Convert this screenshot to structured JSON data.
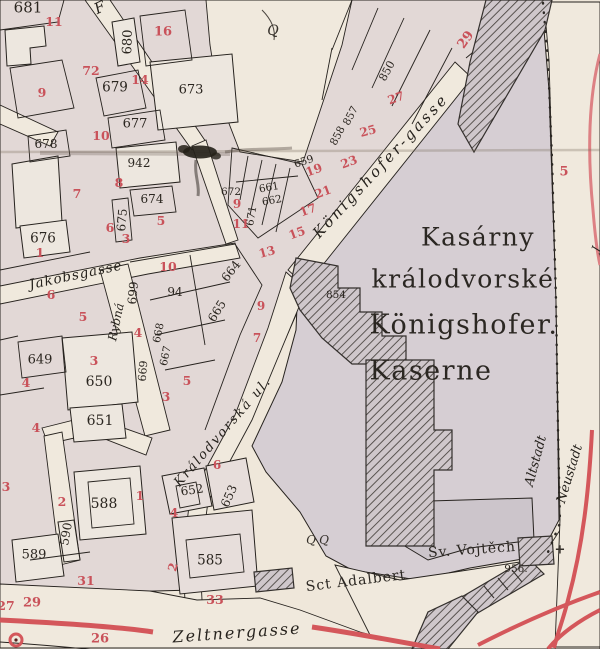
{
  "map_title": "Kasárny králodvorské / Königshofer Kaserne (historic city map detail)",
  "colors": {
    "paper": "#efe7da",
    "block": "#e2d8d6",
    "kaserne_block": "#d6ced3",
    "parcel_white": "#ede7df",
    "hatch_line": "#45403c",
    "outline": "#26221e",
    "house_number_red": "#c9525a",
    "road_red": "#d4575b",
    "boundary_dotted": "#2c2824"
  },
  "labels": {
    "streets": [
      {
        "text": "F",
        "x": 100,
        "y": 8,
        "r": -25,
        "s": 15
      },
      {
        "text": "Jakobsgasse",
        "x": 76,
        "y": 276,
        "r": -12,
        "s": 13.5,
        "ls": 1
      },
      {
        "text": "Rybná",
        "x": 116,
        "y": 322,
        "r": -78,
        "s": 12
      },
      {
        "text": "Königshofer-gasse",
        "x": 381,
        "y": 166,
        "r": -47,
        "s": 15,
        "ls": 3
      },
      {
        "text": "Králodvorská ul.",
        "x": 223,
        "y": 432,
        "r": -49,
        "s": 13,
        "ls": 2
      },
      {
        "text": "Zeltnergasse",
        "x": 237,
        "y": 633,
        "r": -4,
        "s": 16,
        "ls": 2
      },
      {
        "text": "Altstadt",
        "x": 536,
        "y": 461,
        "r": -75,
        "s": 13
      },
      {
        "text": "Neustadt",
        "x": 570,
        "y": 474,
        "r": -73,
        "s": 13
      },
      {
        "text": "J",
        "x": 596,
        "y": 249,
        "r": -70,
        "s": 11
      }
    ],
    "places": [
      {
        "text": "Kasárny",
        "x": 478,
        "y": 237,
        "r": 0,
        "s": 25
      },
      {
        "text": "králodvorské",
        "x": 463,
        "y": 279,
        "r": 0,
        "s": 25
      },
      {
        "text": "Königshofer.",
        "x": 464,
        "y": 325,
        "r": 0,
        "s": 27
      },
      {
        "text": "Kaserne",
        "x": 431,
        "y": 371,
        "r": 0,
        "s": 27
      },
      {
        "text": "Sct Adalbert",
        "x": 356,
        "y": 581,
        "r": -7,
        "s": 14,
        "ls": 1
      },
      {
        "text": "Sv. Vojtěch",
        "x": 472,
        "y": 550,
        "r": -4,
        "s": 14,
        "ls": 1
      }
    ],
    "parcel_numbers": [
      {
        "text": "681",
        "x": 28,
        "y": 8,
        "r": 0,
        "s": 15
      },
      {
        "text": "680",
        "x": 128,
        "y": 42,
        "r": -88,
        "s": 13
      },
      {
        "text": "679",
        "x": 115,
        "y": 88,
        "r": 0,
        "s": 13.5
      },
      {
        "text": "678",
        "x": 46,
        "y": 144,
        "r": 0,
        "s": 12
      },
      {
        "text": "677",
        "x": 135,
        "y": 124,
        "r": 0,
        "s": 13
      },
      {
        "text": "673",
        "x": 191,
        "y": 90,
        "r": 0,
        "s": 13
      },
      {
        "text": "942",
        "x": 139,
        "y": 163,
        "r": 0,
        "s": 12
      },
      {
        "text": "674",
        "x": 152,
        "y": 199,
        "r": 0,
        "s": 12
      },
      {
        "text": "675",
        "x": 122,
        "y": 220,
        "r": -85,
        "s": 12
      },
      {
        "text": "676",
        "x": 43,
        "y": 239,
        "r": 0,
        "s": 13.5
      },
      {
        "text": "672",
        "x": 231,
        "y": 192,
        "r": 0,
        "s": 10.5
      },
      {
        "text": "661",
        "x": 269,
        "y": 188,
        "r": -10,
        "s": 10.5
      },
      {
        "text": "662",
        "x": 272,
        "y": 201,
        "r": -10,
        "s": 10.5
      },
      {
        "text": "671",
        "x": 252,
        "y": 216,
        "r": -80,
        "s": 10.5
      },
      {
        "text": "659",
        "x": 304,
        "y": 162,
        "r": -18,
        "s": 10.5
      },
      {
        "text": "664",
        "x": 231,
        "y": 271,
        "r": -52,
        "s": 12
      },
      {
        "text": "665",
        "x": 217,
        "y": 311,
        "r": -58,
        "s": 12
      },
      {
        "text": "94",
        "x": 175,
        "y": 292,
        "r": 0,
        "s": 12
      },
      {
        "text": "699",
        "x": 133,
        "y": 293,
        "r": -85,
        "s": 12
      },
      {
        "text": "668",
        "x": 159,
        "y": 333,
        "r": -78,
        "s": 10.5
      },
      {
        "text": "667",
        "x": 166,
        "y": 356,
        "r": -78,
        "s": 10.5
      },
      {
        "text": "669",
        "x": 143,
        "y": 371,
        "r": -85,
        "s": 11
      },
      {
        "text": "649",
        "x": 40,
        "y": 360,
        "r": 0,
        "s": 13
      },
      {
        "text": "650",
        "x": 99,
        "y": 382,
        "r": 0,
        "s": 14
      },
      {
        "text": "651",
        "x": 100,
        "y": 421,
        "r": 0,
        "s": 14
      },
      {
        "text": "588",
        "x": 104,
        "y": 504,
        "r": 0,
        "s": 14
      },
      {
        "text": "590",
        "x": 66,
        "y": 534,
        "r": -80,
        "s": 12
      },
      {
        "text": "589",
        "x": 34,
        "y": 555,
        "r": 0,
        "s": 13
      },
      {
        "text": "652",
        "x": 192,
        "y": 490,
        "r": -8,
        "s": 12
      },
      {
        "text": "653",
        "x": 229,
        "y": 496,
        "r": -66,
        "s": 12
      },
      {
        "text": "585",
        "x": 210,
        "y": 561,
        "r": 0,
        "s": 13.5
      },
      {
        "text": "854",
        "x": 336,
        "y": 295,
        "r": 0,
        "s": 10.5
      },
      {
        "text": "850",
        "x": 387,
        "y": 71,
        "r": -62,
        "s": 11
      },
      {
        "text": "857",
        "x": 351,
        "y": 116,
        "r": -62,
        "s": 10.5
      },
      {
        "text": "858",
        "x": 338,
        "y": 136,
        "r": -62,
        "s": 10.5
      },
      {
        "text": "956.",
        "x": 516,
        "y": 569,
        "r": 0,
        "s": 10.5
      }
    ],
    "house_numbers": [
      {
        "text": "11",
        "x": 54,
        "y": 22,
        "r": 0,
        "s": 12.5
      },
      {
        "text": "9",
        "x": 42,
        "y": 93,
        "r": 0,
        "s": 12.5
      },
      {
        "text": "72",
        "x": 91,
        "y": 71,
        "r": 0,
        "s": 12.5
      },
      {
        "text": "16",
        "x": 163,
        "y": 32,
        "r": 0,
        "s": 13
      },
      {
        "text": "14",
        "x": 140,
        "y": 80,
        "r": 0,
        "s": 12.5
      },
      {
        "text": "10",
        "x": 101,
        "y": 136,
        "r": 0,
        "s": 12.5
      },
      {
        "text": "8",
        "x": 119,
        "y": 183,
        "r": 0,
        "s": 12.5
      },
      {
        "text": "7",
        "x": 77,
        "y": 194,
        "r": 0,
        "s": 12.5
      },
      {
        "text": "6",
        "x": 110,
        "y": 228,
        "r": 0,
        "s": 12.5
      },
      {
        "text": "5",
        "x": 161,
        "y": 221,
        "r": 0,
        "s": 12.5
      },
      {
        "text": "3",
        "x": 126,
        "y": 239,
        "r": 0,
        "s": 12.5
      },
      {
        "text": "1",
        "x": 40,
        "y": 253,
        "r": 0,
        "s": 12.5
      },
      {
        "text": "6",
        "x": 51,
        "y": 295,
        "r": 0,
        "s": 12.5
      },
      {
        "text": "5",
        "x": 83,
        "y": 317,
        "r": 0,
        "s": 12.5
      },
      {
        "text": "3",
        "x": 94,
        "y": 361,
        "r": 0,
        "s": 12.5
      },
      {
        "text": "4",
        "x": 26,
        "y": 383,
        "r": 0,
        "s": 12.5
      },
      {
        "text": "10",
        "x": 168,
        "y": 267,
        "r": 0,
        "s": 12.5
      },
      {
        "text": "4",
        "x": 138,
        "y": 333,
        "r": 0,
        "s": 12.5
      },
      {
        "text": "5",
        "x": 187,
        "y": 381,
        "r": 0,
        "s": 12.5
      },
      {
        "text": "3",
        "x": 166,
        "y": 397,
        "r": 0,
        "s": 12.5
      },
      {
        "text": "9",
        "x": 237,
        "y": 204,
        "r": 0,
        "s": 12
      },
      {
        "text": "11",
        "x": 241,
        "y": 224,
        "r": 0,
        "s": 12
      },
      {
        "text": "13",
        "x": 267,
        "y": 252,
        "r": -15,
        "s": 12
      },
      {
        "text": "15",
        "x": 297,
        "y": 233,
        "r": -20,
        "s": 12
      },
      {
        "text": "17",
        "x": 308,
        "y": 210,
        "r": -20,
        "s": 12
      },
      {
        "text": "19",
        "x": 314,
        "y": 170,
        "r": -20,
        "s": 12
      },
      {
        "text": "21",
        "x": 323,
        "y": 192,
        "r": -20,
        "s": 12
      },
      {
        "text": "23",
        "x": 349,
        "y": 162,
        "r": -20,
        "s": 12
      },
      {
        "text": "25",
        "x": 368,
        "y": 131,
        "r": -15,
        "s": 12
      },
      {
        "text": "27",
        "x": 396,
        "y": 98,
        "r": -20,
        "s": 12
      },
      {
        "text": "29",
        "x": 466,
        "y": 40,
        "r": -55,
        "s": 13
      },
      {
        "text": "5",
        "x": 564,
        "y": 172,
        "r": 0,
        "s": 13
      },
      {
        "text": "9",
        "x": 261,
        "y": 306,
        "r": 0,
        "s": 12
      },
      {
        "text": "7",
        "x": 257,
        "y": 338,
        "r": 0,
        "s": 12
      },
      {
        "text": "1",
        "x": 140,
        "y": 496,
        "r": 0,
        "s": 12.5
      },
      {
        "text": "2",
        "x": 62,
        "y": 502,
        "r": 0,
        "s": 12.5
      },
      {
        "text": "3",
        "x": 6,
        "y": 487,
        "r": 0,
        "s": 12.5
      },
      {
        "text": "4",
        "x": 36,
        "y": 428,
        "r": 0,
        "s": 12.5
      },
      {
        "text": "4",
        "x": 174,
        "y": 513,
        "r": 0,
        "s": 12.5
      },
      {
        "text": "6",
        "x": 217,
        "y": 465,
        "r": 0,
        "s": 12
      },
      {
        "text": "2",
        "x": 173,
        "y": 567,
        "r": -75,
        "s": 12
      },
      {
        "text": "33",
        "x": 215,
        "y": 600,
        "r": 0,
        "s": 12.5
      },
      {
        "text": "31",
        "x": 86,
        "y": 581,
        "r": 0,
        "s": 12.5
      },
      {
        "text": "29",
        "x": 32,
        "y": 603,
        "r": 0,
        "s": 13
      },
      {
        "text": "27",
        "x": 6,
        "y": 606,
        "r": 0,
        "s": 12.5
      },
      {
        "text": "26",
        "x": 100,
        "y": 639,
        "r": 0,
        "s": 13
      }
    ],
    "symbols": [
      {
        "text": "Q",
        "x": 273,
        "y": 31,
        "r": 0,
        "s": 14
      },
      {
        "text": "Q",
        "x": 311,
        "y": 540,
        "r": 0,
        "s": 12
      },
      {
        "text": "Q",
        "x": 324,
        "y": 540,
        "r": 0,
        "s": 12
      },
      {
        "text": "+",
        "x": 560,
        "y": 550,
        "r": 0,
        "s": 13,
        "red": true
      }
    ]
  }
}
